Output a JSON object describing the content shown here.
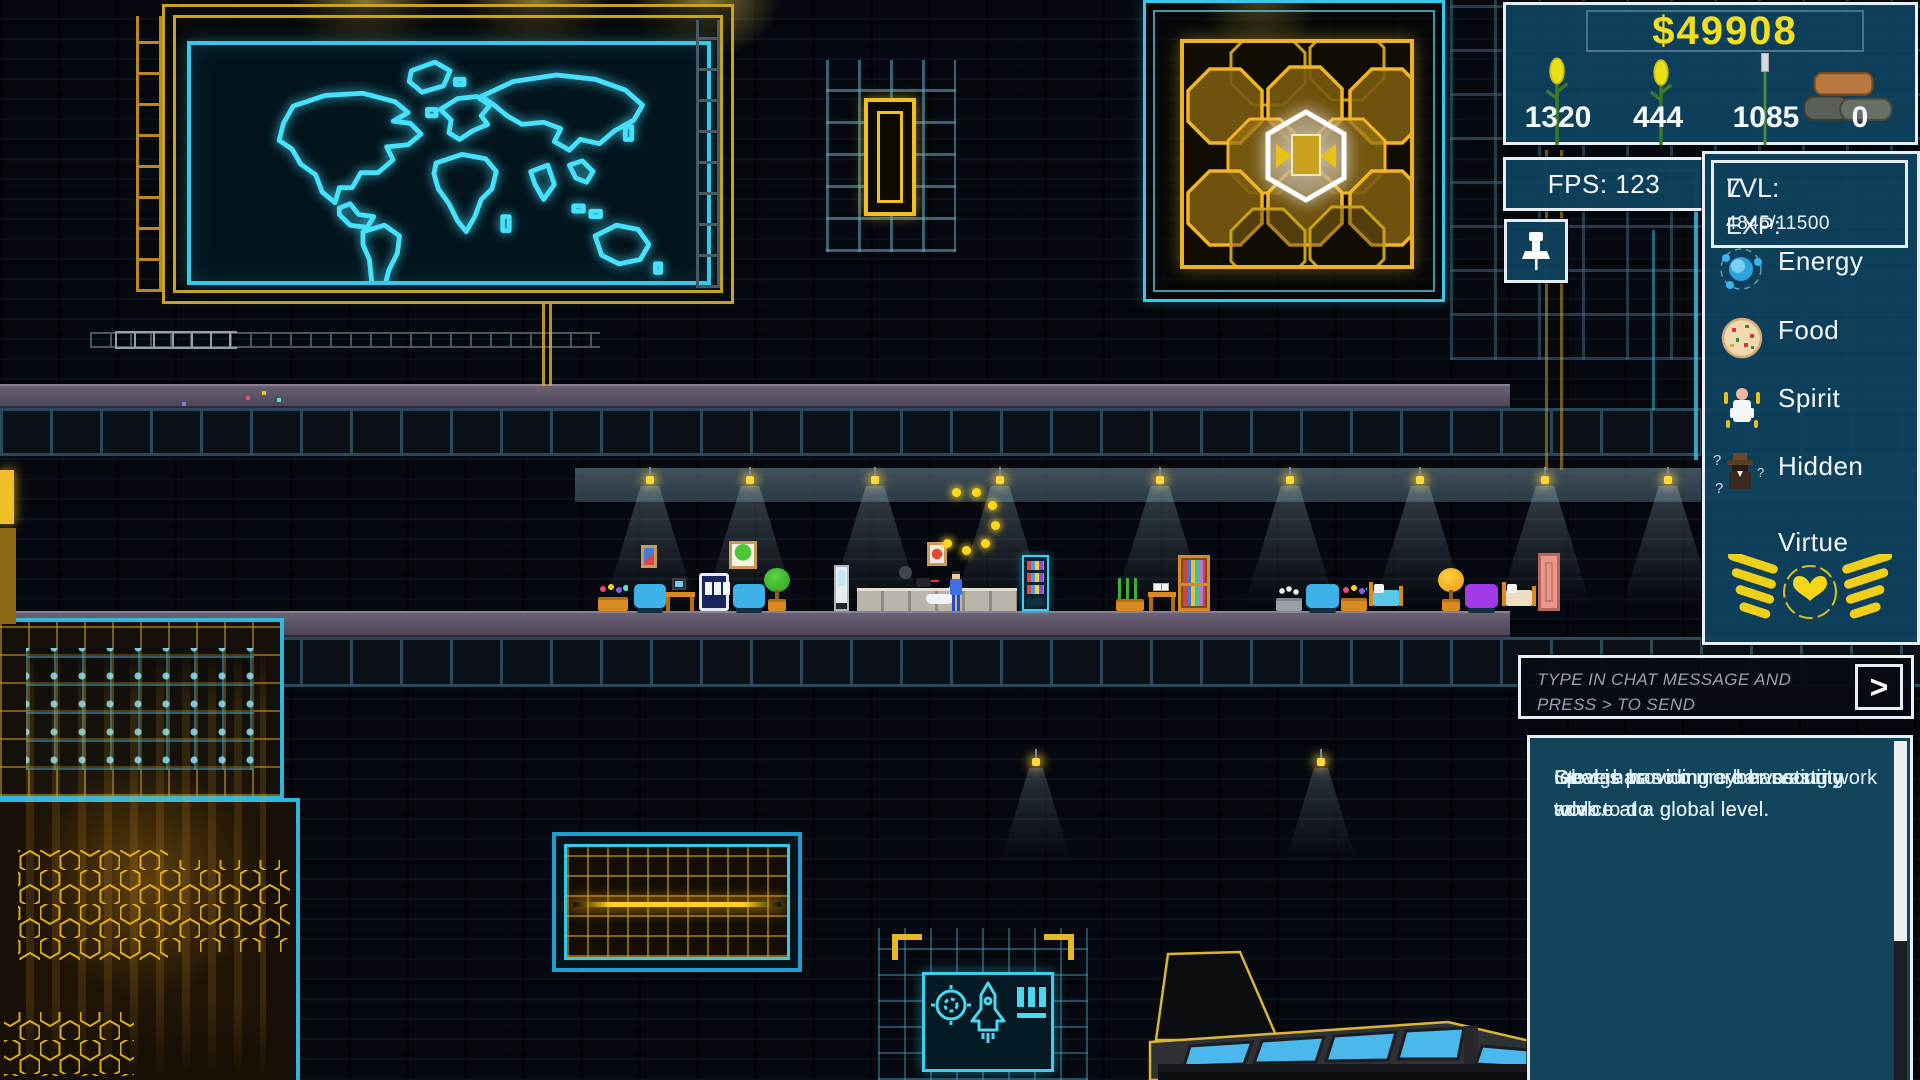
{
  "hud": {
    "money": "$49908",
    "resources": [
      {
        "name": "corn",
        "icon": "corn-icon",
        "value": "1320"
      },
      {
        "name": "corn-sprout",
        "icon": "corn-icon",
        "value": "444"
      },
      {
        "name": "reed",
        "icon": "reed-icon",
        "value": "1085"
      },
      {
        "name": "stone",
        "icon": "stone-pile-icon",
        "value": "0"
      }
    ],
    "fps": "FPS: 123",
    "pin_icon": "pushpin",
    "level": {
      "label": "LVL:",
      "value": "7"
    },
    "exp": {
      "label": "EXP:",
      "value": "4845/11500"
    },
    "stats": [
      {
        "label": "Energy",
        "icon": "atom-icon",
        "fill_width": "100%",
        "fill_color": "#00d9ef",
        "track_color": "#00d9ef"
      },
      {
        "label": "Food",
        "icon": "pizza-icon",
        "fill_width": "88%",
        "fill_color": "#ffc713",
        "track_color": "#e30016"
      },
      {
        "label": "Spirit",
        "icon": "meditating-person-icon",
        "fill_width": "65%",
        "fill_color": "#8e00ee",
        "track_color": "#e30016"
      },
      {
        "label": "Hidden",
        "icon": "spy-icon",
        "fill_width": "100%",
        "fill_color": "#ffffff",
        "track_color": "#ffffff"
      }
    ],
    "virtue": {
      "label": "Virtue",
      "icon": "winged-heart-icon"
    }
  },
  "chat": {
    "placeholder": "TYPE IN CHAT MESSAGE AND PRESS > TO SEND",
    "send_label": ">",
    "send_icon": "chevron-right",
    "messages": [
      "Iqbal is providing cyber security advice at a global level.",
      "George has no more harvesting work to do.",
      "Steve has no more harvesting work to do.",
      "Iqbal is providing cyber security advice at a global level."
    ]
  },
  "world": {
    "colors": {
      "neon_cyan": "#3bd2f2",
      "neon_gold": "#eab227",
      "map_glow": "#46e2fc"
    }
  }
}
